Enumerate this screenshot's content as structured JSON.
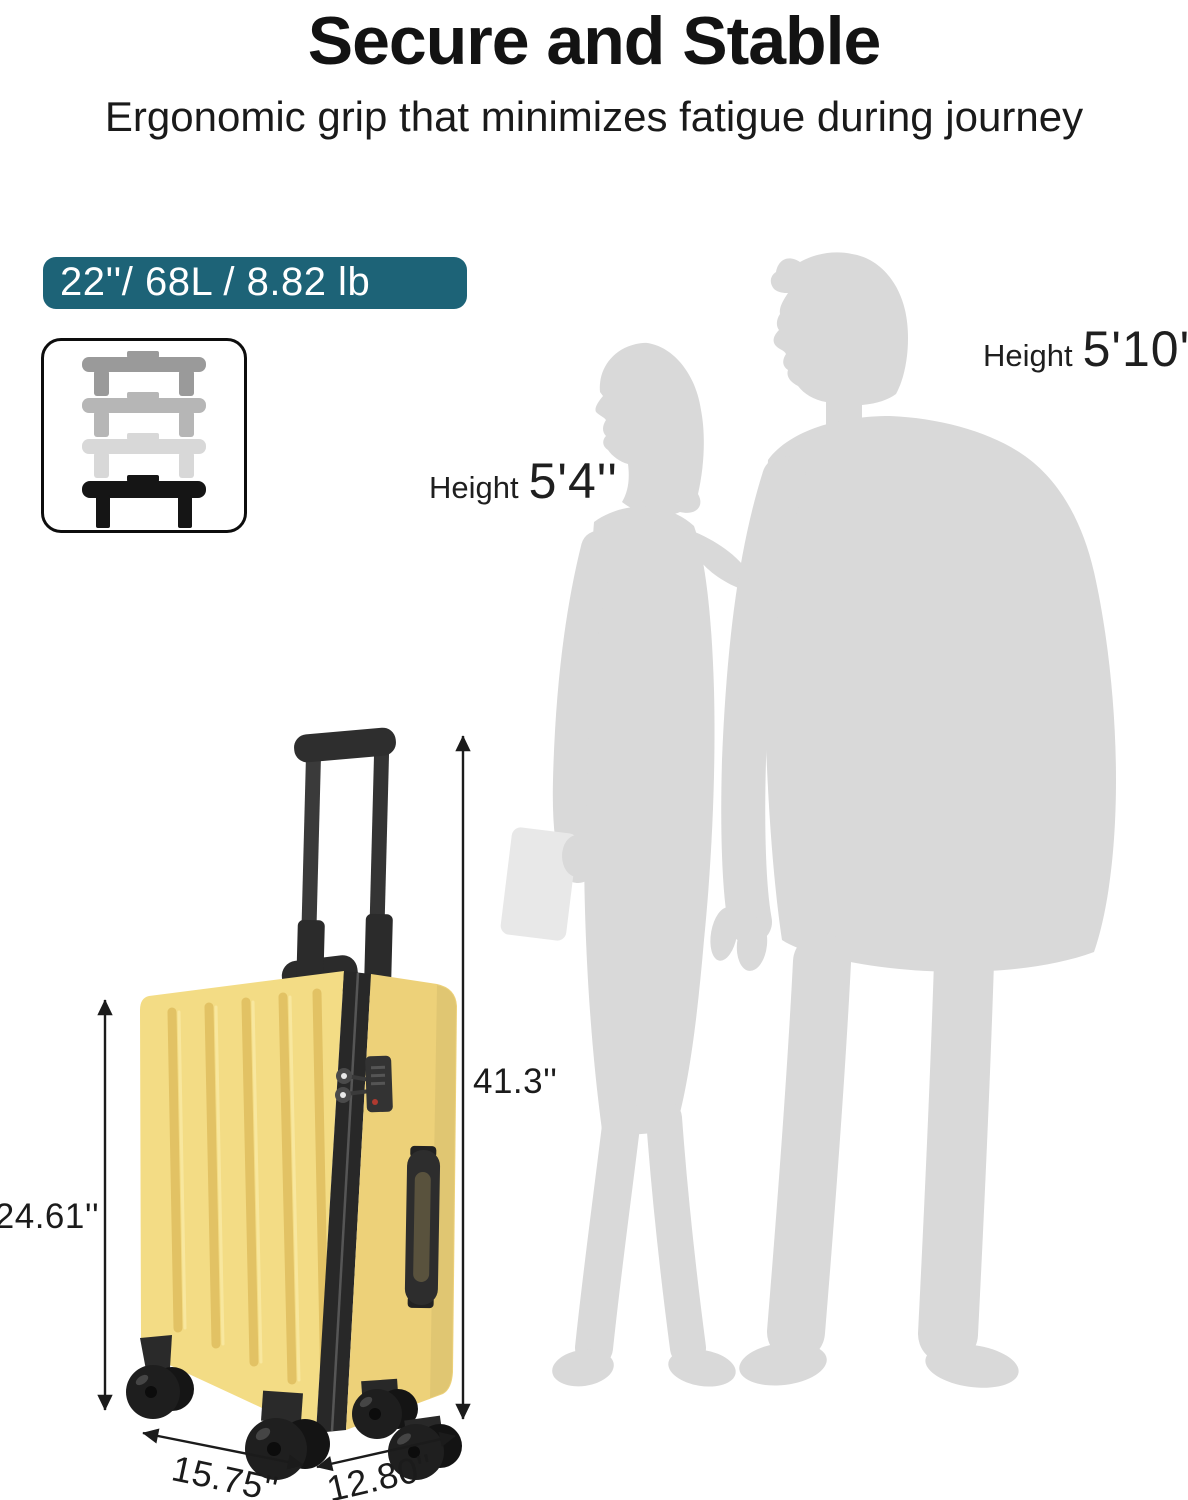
{
  "header": {
    "title": "Secure and Stable",
    "subtitle": "Ergonomic grip that minimizes fatigue during journey"
  },
  "spec_badge": {
    "text": "22''/ 68L / 8.82 lb",
    "bg_color": "#1d6377",
    "text_color": "#ffffff"
  },
  "handle_diagram": {
    "stage_colors": [
      "#9a9a9a",
      "#b6b6b6",
      "#d8d8d8",
      "#151515"
    ]
  },
  "people": {
    "silhouette_color": "#d9d9d9",
    "woman": {
      "label": "Height",
      "value": "5'4''"
    },
    "man": {
      "label": "Height",
      "value": "5'10''"
    }
  },
  "suitcase": {
    "shell_color": "#f3dc85",
    "shell_color_dark": "#edd179",
    "trim_color": "#282828",
    "groove_color": "#e2c264"
  },
  "dimensions": {
    "overall_height": "41.3''",
    "body_height": "24.61''",
    "width": "15.75''",
    "depth": "12.80''"
  }
}
